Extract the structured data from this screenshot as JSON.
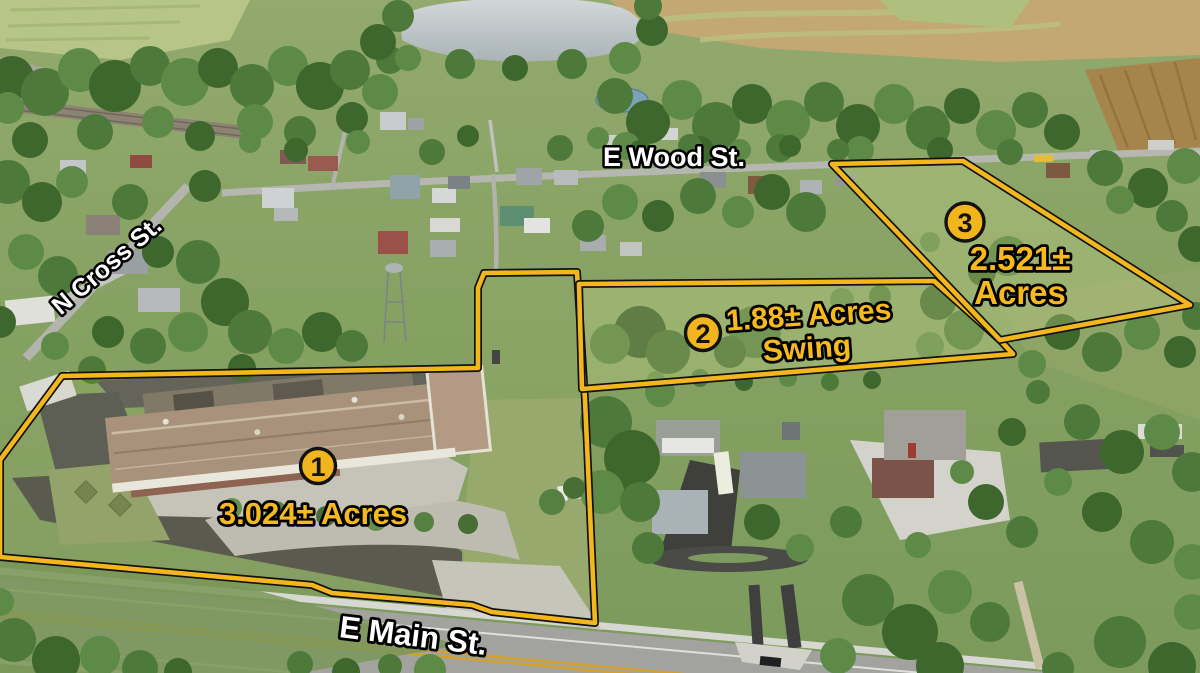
{
  "streets": [
    {
      "name": "E Wood St."
    },
    {
      "name": "N Cross St."
    },
    {
      "name": "E Main St."
    }
  ],
  "parcels": [
    {
      "number": "1",
      "acreage_line1": "3.024± Acres",
      "acreage_line2": "",
      "outline_points": "62,376 478,368 478,288 484,273 577,272 585,400 595,623 492,612 472,605 332,593 312,585 0,557 0,460"
    },
    {
      "number": "2",
      "acreage_line1": "1.88± Acres",
      "acreage_line2": "Swing",
      "outline_points": "579,284 934,281 1000,340 1013,354 582,389"
    },
    {
      "number": "3",
      "acreage_line1": "2.521±",
      "acreage_line2": "Acres",
      "outline_points": "832,164 963,161 1190,305 1000,340"
    }
  ],
  "colors": {
    "outline_yellow": "#F3B71D",
    "badge_fill": "#F2B51D",
    "badge_number": "#131313",
    "acreage_text": "#F7BA1E",
    "street_text": "#FFFFFF",
    "text_outline": "#000000"
  }
}
